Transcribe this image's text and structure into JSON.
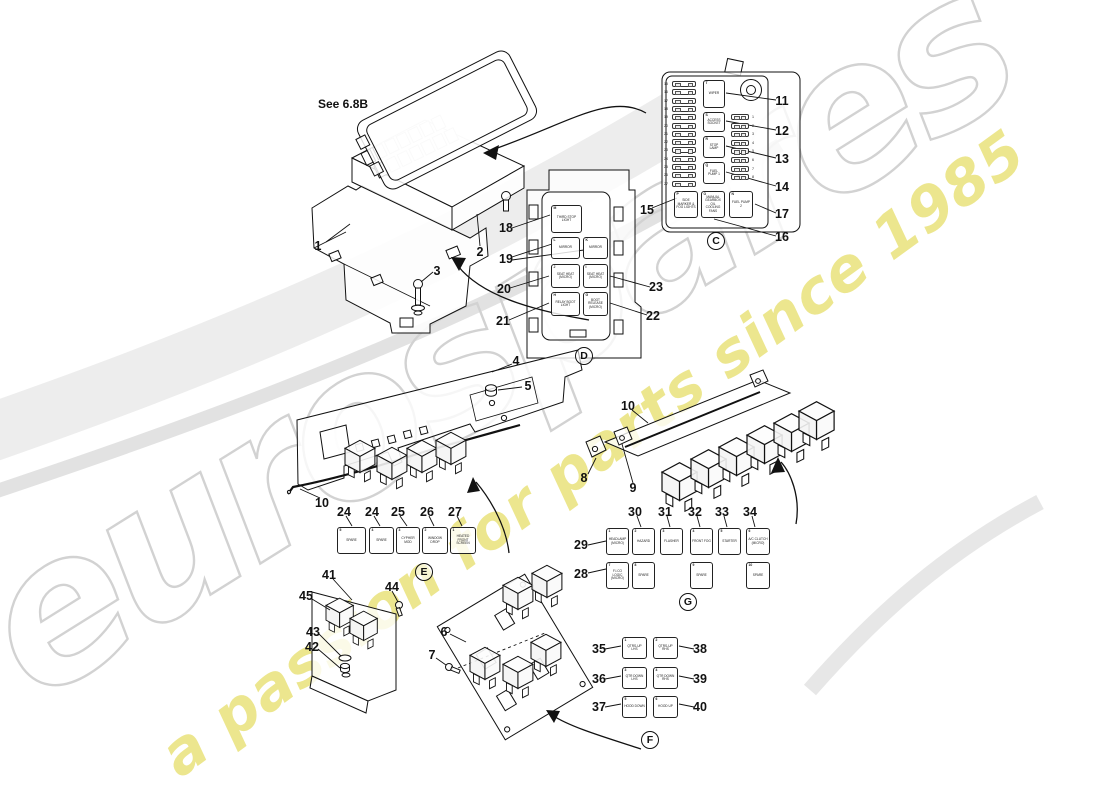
{
  "watermark": {
    "brand_text": "eurospares",
    "tagline_text": "a passion for parts since 1985",
    "brand_stroke_color": "#d2d2d2",
    "tagline_color": "#e9e27a",
    "swoosh_color": "#ececec"
  },
  "annotations": {
    "see_note": "See 6.8B"
  },
  "section_markers": [
    {
      "letter": "C",
      "x": 716,
      "y": 241
    },
    {
      "letter": "D",
      "x": 584,
      "y": 356
    },
    {
      "letter": "E",
      "x": 424,
      "y": 572
    },
    {
      "letter": "G",
      "x": 688,
      "y": 602
    },
    {
      "letter": "F",
      "x": 650,
      "y": 740
    }
  ],
  "callouts": [
    {
      "n": "1",
      "x": 318,
      "y": 246
    },
    {
      "n": "2",
      "x": 480,
      "y": 252
    },
    {
      "n": "3",
      "x": 437,
      "y": 271
    },
    {
      "n": "4",
      "x": 516,
      "y": 361
    },
    {
      "n": "5",
      "x": 528,
      "y": 386
    },
    {
      "n": "10",
      "x": 322,
      "y": 503
    },
    {
      "n": "24",
      "x": 344,
      "y": 512
    },
    {
      "n": "24",
      "x": 372,
      "y": 512
    },
    {
      "n": "25",
      "x": 398,
      "y": 512
    },
    {
      "n": "26",
      "x": 427,
      "y": 512
    },
    {
      "n": "27",
      "x": 455,
      "y": 512
    },
    {
      "n": "8",
      "x": 584,
      "y": 478
    },
    {
      "n": "9",
      "x": 633,
      "y": 488
    },
    {
      "n": "10",
      "x": 628,
      "y": 406
    },
    {
      "n": "11",
      "x": 782,
      "y": 101
    },
    {
      "n": "12",
      "x": 782,
      "y": 131
    },
    {
      "n": "13",
      "x": 782,
      "y": 159
    },
    {
      "n": "14",
      "x": 782,
      "y": 187
    },
    {
      "n": "17",
      "x": 782,
      "y": 214
    },
    {
      "n": "16",
      "x": 782,
      "y": 237
    },
    {
      "n": "15",
      "x": 647,
      "y": 210
    },
    {
      "n": "18",
      "x": 506,
      "y": 228
    },
    {
      "n": "19",
      "x": 506,
      "y": 259
    },
    {
      "n": "20",
      "x": 504,
      "y": 289
    },
    {
      "n": "21",
      "x": 503,
      "y": 321
    },
    {
      "n": "22",
      "x": 653,
      "y": 316
    },
    {
      "n": "23",
      "x": 656,
      "y": 287
    },
    {
      "n": "29",
      "x": 581,
      "y": 545
    },
    {
      "n": "28",
      "x": 581,
      "y": 574
    },
    {
      "n": "30",
      "x": 635,
      "y": 512
    },
    {
      "n": "31",
      "x": 665,
      "y": 512
    },
    {
      "n": "32",
      "x": 695,
      "y": 512
    },
    {
      "n": "33",
      "x": 722,
      "y": 512
    },
    {
      "n": "34",
      "x": 750,
      "y": 512
    },
    {
      "n": "35",
      "x": 599,
      "y": 649
    },
    {
      "n": "36",
      "x": 599,
      "y": 679
    },
    {
      "n": "37",
      "x": 599,
      "y": 707
    },
    {
      "n": "38",
      "x": 700,
      "y": 649
    },
    {
      "n": "39",
      "x": 700,
      "y": 679
    },
    {
      "n": "40",
      "x": 700,
      "y": 707
    },
    {
      "n": "41",
      "x": 329,
      "y": 575
    },
    {
      "n": "44",
      "x": 392,
      "y": 587
    },
    {
      "n": "45",
      "x": 306,
      "y": 596
    },
    {
      "n": "43",
      "x": 313,
      "y": 632
    },
    {
      "n": "42",
      "x": 312,
      "y": 647
    },
    {
      "n": "6",
      "x": 444,
      "y": 632
    },
    {
      "n": "7",
      "x": 432,
      "y": 655
    }
  ],
  "relay_groups": [
    {
      "name": "panel-c",
      "boxes": [
        {
          "x": 703,
          "y": 80,
          "w": 22,
          "h": 28,
          "corner": "T",
          "label": "WIPER"
        },
        {
          "x": 703,
          "y": 112,
          "w": 22,
          "h": 20,
          "corner": "S",
          "label": "ACCESS SOCKET"
        },
        {
          "x": 703,
          "y": 136,
          "w": 22,
          "h": 22,
          "corner": "R",
          "label": "STOP LAMP"
        },
        {
          "x": 703,
          "y": 162,
          "w": 22,
          "h": 22,
          "corner": "Q",
          "label": "FUEL PUMP 1"
        },
        {
          "x": 674,
          "y": 191,
          "w": 24,
          "h": 27,
          "corner": "P",
          "label": "SIDE MARKER & FOG LIGHTS"
        },
        {
          "x": 701,
          "y": 191,
          "w": 24,
          "h": 27,
          "corner": "O",
          "label": "MANUAL GEARBOX OIL COOLING FANS"
        },
        {
          "x": 729,
          "y": 191,
          "w": 24,
          "h": 27,
          "corner": "N",
          "label": "FUEL PUMP 2"
        }
      ]
    },
    {
      "name": "panel-d",
      "boxes": [
        {
          "x": 551,
          "y": 205,
          "w": 31,
          "h": 28,
          "corner": "M",
          "label": "THIRD STOP LIGHT"
        },
        {
          "x": 551,
          "y": 237,
          "w": 29,
          "h": 22,
          "corner": "L",
          "label": "MIRROR"
        },
        {
          "x": 583,
          "y": 237,
          "w": 25,
          "h": 22,
          "corner": "K",
          "label": "MIRROR"
        },
        {
          "x": 551,
          "y": 264,
          "w": 29,
          "h": 24,
          "corner": "J",
          "label": "SEAT HEAT (MICRO)"
        },
        {
          "x": 583,
          "y": 264,
          "w": 25,
          "h": 24,
          "corner": "I",
          "label": "SEAT HEAT (MICRO)"
        },
        {
          "x": 551,
          "y": 292,
          "w": 29,
          "h": 24,
          "corner": "H",
          "label": "RELAY BOOT LIGHT"
        },
        {
          "x": 583,
          "y": 292,
          "w": 25,
          "h": 24,
          "corner": "G",
          "label": "BOOT RELEASE (MICRO)"
        }
      ]
    },
    {
      "name": "row-e",
      "boxes": [
        {
          "x": 337,
          "y": 527,
          "w": 29,
          "h": 27,
          "corner": "5",
          "label": "SPARE"
        },
        {
          "x": 369,
          "y": 527,
          "w": 25,
          "h": 27,
          "corner": "4",
          "label": "SPARE"
        },
        {
          "x": 396,
          "y": 527,
          "w": 24,
          "h": 27,
          "corner": "3",
          "label": "CYPHER MOD"
        },
        {
          "x": 422,
          "y": 527,
          "w": 26,
          "h": 27,
          "corner": "2",
          "label": "WINDOW DROP"
        },
        {
          "x": 450,
          "y": 527,
          "w": 26,
          "h": 27,
          "corner": "1",
          "label": "HEATED FRONT SCREEN"
        }
      ]
    },
    {
      "name": "group-g",
      "boxes": [
        {
          "x": 606,
          "y": 528,
          "w": 23,
          "h": 27,
          "corner": "1",
          "label": "HEADLAMP (MICRO)"
        },
        {
          "x": 632,
          "y": 528,
          "w": 23,
          "h": 27,
          "corner": "2",
          "label": "HAZARD"
        },
        {
          "x": 660,
          "y": 528,
          "w": 23,
          "h": 27,
          "corner": "3",
          "label": "FLASHER"
        },
        {
          "x": 690,
          "y": 528,
          "w": 23,
          "h": 27,
          "corner": "4",
          "label": "FRONT FOG"
        },
        {
          "x": 718,
          "y": 528,
          "w": 23,
          "h": 27,
          "corner": "5",
          "label": "STARTER"
        },
        {
          "x": 746,
          "y": 528,
          "w": 24,
          "h": 27,
          "corner": "6",
          "label": "A/C CLUTCH (MICRO)"
        },
        {
          "x": 606,
          "y": 562,
          "w": 23,
          "h": 27,
          "corner": "7",
          "label": "F.I.CO LOGIC (MICRO)"
        },
        {
          "x": 632,
          "y": 562,
          "w": 23,
          "h": 27,
          "corner": "8",
          "label": "SPARE"
        },
        {
          "x": 690,
          "y": 562,
          "w": 23,
          "h": 27,
          "corner": "9",
          "label": "SPARE"
        },
        {
          "x": 746,
          "y": 562,
          "w": 24,
          "h": 27,
          "corner": "10",
          "label": "SPARE"
        }
      ]
    },
    {
      "name": "group-f",
      "boxes": [
        {
          "x": 622,
          "y": 637,
          "w": 25,
          "h": 22,
          "corner": "1",
          "label": "QTRS-UP LHS"
        },
        {
          "x": 653,
          "y": 637,
          "w": 25,
          "h": 22,
          "corner": "2",
          "label": "QTRS-UP RHS"
        },
        {
          "x": 622,
          "y": 667,
          "w": 25,
          "h": 22,
          "corner": "3",
          "label": "QTR DOWN LHS"
        },
        {
          "x": 653,
          "y": 667,
          "w": 25,
          "h": 22,
          "corner": "4",
          "label": "QTR DOWN RHS"
        },
        {
          "x": 622,
          "y": 696,
          "w": 25,
          "h": 22,
          "corner": "5",
          "label": "HOOD DOWN"
        },
        {
          "x": 653,
          "y": 696,
          "w": 25,
          "h": 22,
          "corner": "6",
          "label": "HOOD UP"
        }
      ]
    }
  ],
  "fuse_columns": [
    {
      "name": "panel-c-left",
      "x": 672,
      "y": 81,
      "w": 24,
      "h": 6,
      "step": 8.3,
      "side": "left",
      "numbers": [
        "15",
        "16",
        "17",
        "18",
        "19",
        "20",
        "21",
        "22",
        "23",
        "24",
        "25",
        "26",
        "27"
      ]
    },
    {
      "name": "panel-c-right",
      "x": 731,
      "y": 114,
      "w": 18,
      "h": 6,
      "step": 8.6,
      "side": "right",
      "numbers": [
        "1",
        "2",
        "3",
        "4",
        "5",
        "6",
        "7",
        "8"
      ]
    }
  ]
}
